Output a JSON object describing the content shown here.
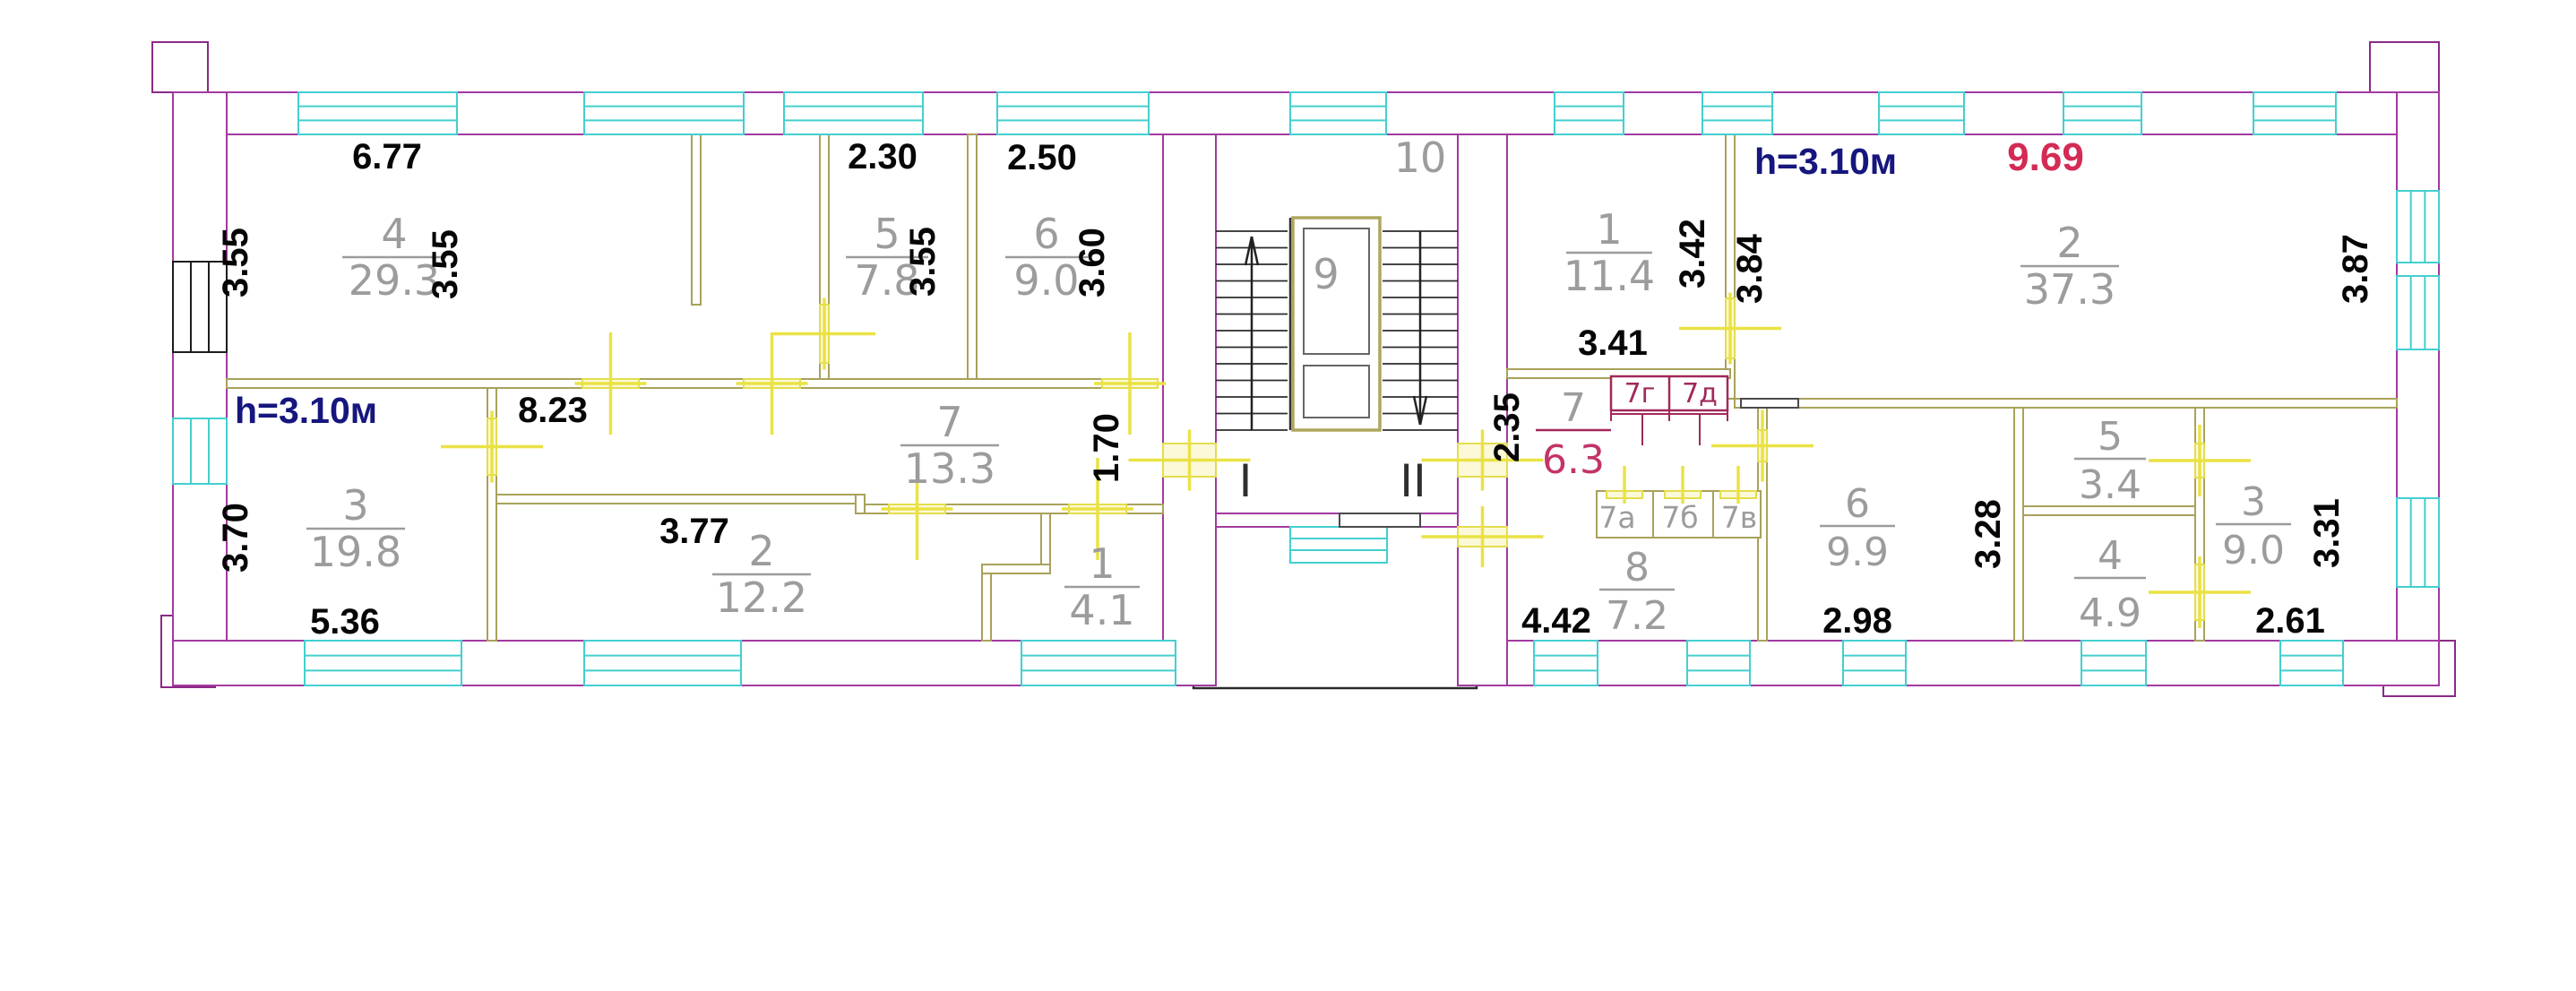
{
  "plan": {
    "left_unit": {
      "height_note": "h=3.10м",
      "rooms": [
        {
          "num": "4",
          "area": "29.3"
        },
        {
          "num": "5",
          "area": "7.8"
        },
        {
          "num": "6",
          "area": "9.0"
        },
        {
          "num": "3",
          "area": "19.8"
        },
        {
          "num": "7",
          "area": "13.3"
        },
        {
          "num": "2",
          "area": "12.2"
        },
        {
          "num": "1",
          "area": "4.1"
        }
      ],
      "dims": {
        "top_w": "6.77",
        "room5_w": "2.30",
        "room6_w": "2.50",
        "left_h": "3.55",
        "mid_h": "3.55",
        "room5_h": "3.55",
        "room6_h": "3.60",
        "corridor_w": "8.23",
        "room3_h": "3.70",
        "room3_w": "5.36",
        "room2_w": "3.77",
        "hall_h": "1.70"
      }
    },
    "stairwell": {
      "upper_flat": "10",
      "lift": "9",
      "entrance_left": "I",
      "entrance_right": "II"
    },
    "right_unit": {
      "height_note": "h=3.10м",
      "red_dim": "9.69",
      "rooms": [
        {
          "num": "1",
          "area": "11.4"
        },
        {
          "num": "2",
          "area": "37.3"
        },
        {
          "num": "7",
          "area": "6.3"
        },
        {
          "num": "8",
          "area": "7.2"
        },
        {
          "num": "6",
          "area": "9.9"
        },
        {
          "num": "5",
          "area": "3.4"
        },
        {
          "num": "4",
          "area": "4.9"
        },
        {
          "num": "3",
          "area": "9.0"
        }
      ],
      "closets": [
        {
          "label": "7а"
        },
        {
          "label": "7б"
        },
        {
          "label": "7в"
        },
        {
          "label": "7г"
        },
        {
          "label": "7д"
        }
      ],
      "dims": {
        "room1_h": "3.42",
        "room2_h": "3.84",
        "room1_w": "3.41",
        "room2_right_h": "3.87",
        "room7_h": "2.35",
        "room8_w": "4.42",
        "room6_w": "2.98",
        "room6_h": "3.28",
        "room3_w": "2.61",
        "room3_h": "3.31"
      }
    }
  }
}
